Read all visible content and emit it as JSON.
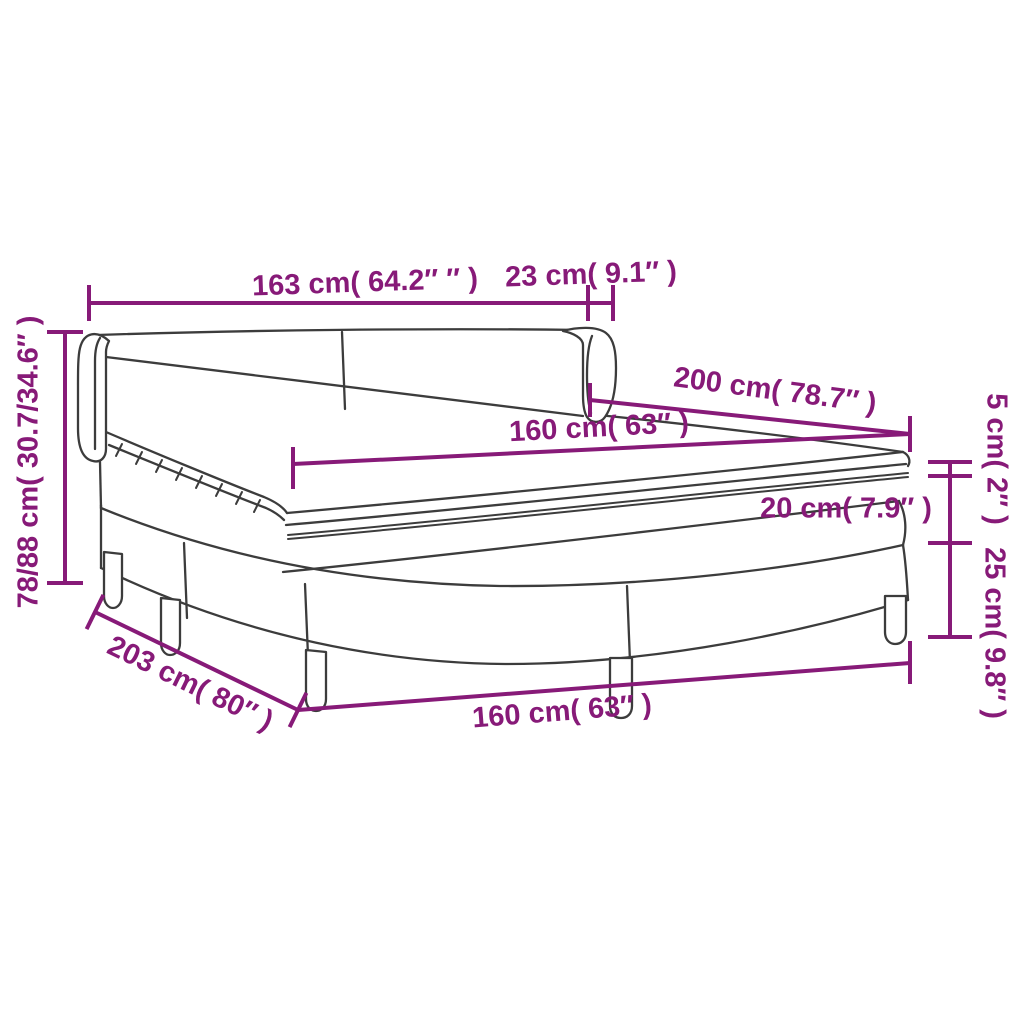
{
  "image": {
    "description": "Box spring bed with headboard, mattress and topper - product dimension diagram",
    "background_color": "#ffffff",
    "accent_color": "#871a78",
    "line_color": "#3c3c3c"
  },
  "dimensions": {
    "headboard_width": "163 cm( 64.2″ ″ )",
    "wing_depth": "23 cm( 9.1″ )",
    "bed_length": "200 cm( 78.7″ )",
    "mattress_width_top": "160 cm( 63″ )",
    "topper_height": "5 cm( 2″ )",
    "mattress_height": "20 cm( 7.9″ )",
    "base_height": "25 cm( 9.8″ )",
    "total_height": "78/88 cm( 30.7/34.6″ )",
    "frame_depth": "203 cm( 80″ )",
    "frame_width_bottom": "160 cm( 63″ )"
  }
}
